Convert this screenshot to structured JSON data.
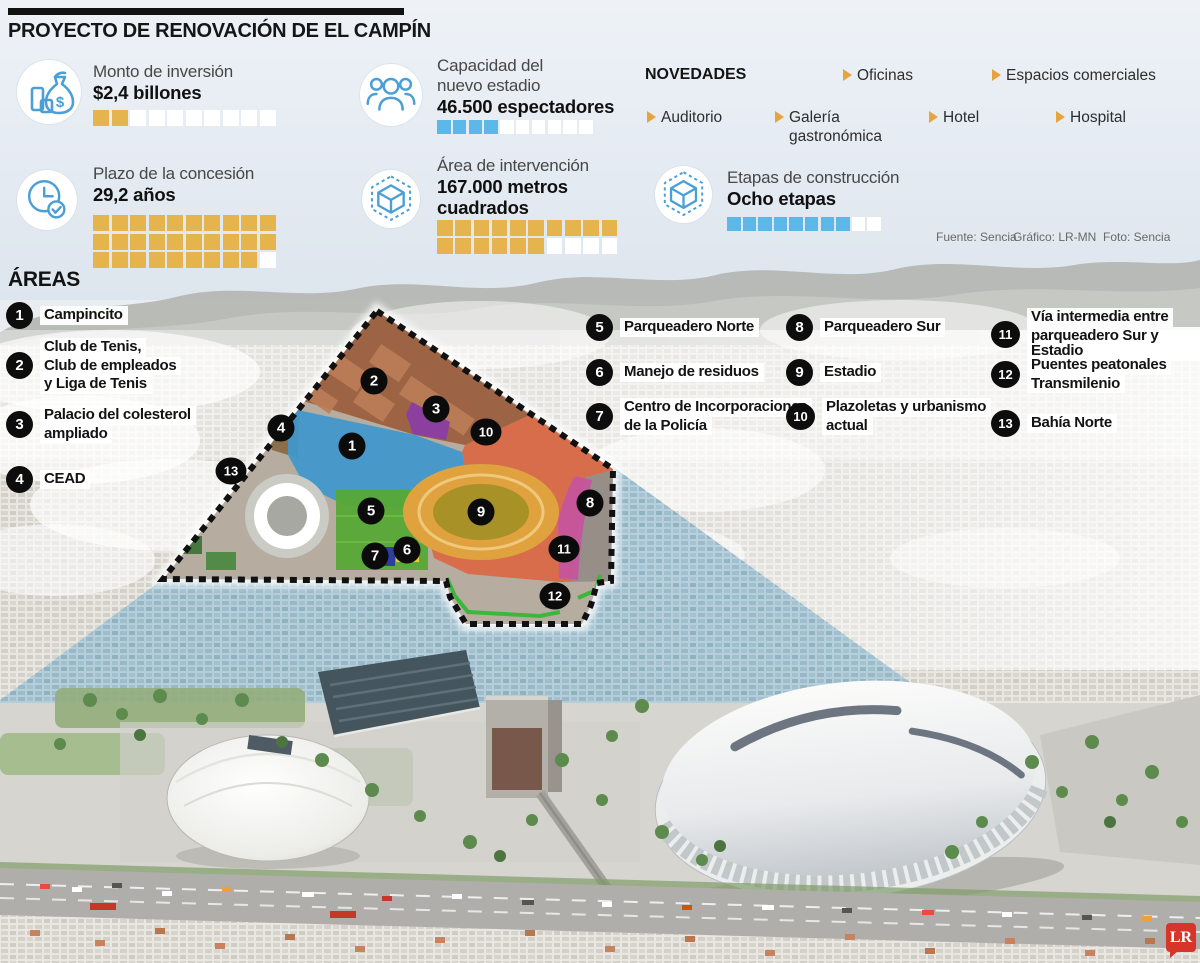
{
  "title": "PROYECTO DE RENOVACIÓN DE EL CAMPÍN",
  "colors": {
    "accent_gold": "#e6b44c",
    "accent_blue": "#5cb8e8",
    "square_empty": "#ffffff",
    "icon_blue": "#4aa0d6",
    "marker_black": "#0b0b0b",
    "logo_red": "#d8352a"
  },
  "stats": {
    "monto": {
      "icon": "money-bag-icon",
      "label_lines": [
        "Monto de inversión"
      ],
      "value_lines": [
        "$2,4 billones"
      ],
      "squares": {
        "filled": 2,
        "total": 10,
        "per_row": 10,
        "color": "#e6b44c"
      }
    },
    "capacidad": {
      "icon": "people-icon",
      "label_lines": [
        "Capacidad del",
        "nuevo estadio"
      ],
      "value_lines": [
        "46.500 espectadores"
      ],
      "squares": {
        "filled": 4,
        "total": 10,
        "per_row": 10,
        "color": "#5cb8e8"
      }
    },
    "plazo": {
      "icon": "clock-icon",
      "label_lines": [
        "Plazo de la concesión"
      ],
      "value_lines": [
        "29,2 años"
      ],
      "squares": {
        "filled": 29,
        "total": 30,
        "per_row": 10,
        "color": "#e6b44c"
      }
    },
    "area": {
      "icon": "cube-icon",
      "label_lines": [
        "Área de intervención"
      ],
      "value_lines": [
        "167.000 metros",
        "cuadrados"
      ],
      "squares": {
        "filled": 16,
        "total": 20,
        "per_row": 10,
        "color": "#e6b44c"
      }
    },
    "etapas": {
      "icon": "cube-icon",
      "label_lines": [
        "Etapas de construcción"
      ],
      "value_lines": [
        "Ocho etapas"
      ],
      "squares": {
        "filled": 8,
        "total": 10,
        "per_row": 10,
        "color": "#5cb8e8"
      }
    }
  },
  "novedades": {
    "heading": "NOVEDADES",
    "items": [
      "Auditorio",
      "Galería gastronómica",
      "Oficinas",
      "Espacios comerciales",
      "Hotel",
      "Hospital"
    ]
  },
  "credits": {
    "fuente": "Fuente: Sencia",
    "grafico": "Gráfico: LR-MN",
    "foto": "Foto: Sencia"
  },
  "areas": {
    "heading": "ÁREAS",
    "items": [
      {
        "num": "1",
        "lines": [
          "Campincito"
        ]
      },
      {
        "num": "2",
        "lines": [
          "Club de Tenis,",
          "Club de empleados",
          "y Liga de Tenis"
        ]
      },
      {
        "num": "3",
        "lines": [
          "Palacio del colesterol",
          "ampliado"
        ]
      },
      {
        "num": "4",
        "lines": [
          "CEAD"
        ]
      },
      {
        "num": "5",
        "lines": [
          "Parqueadero Norte"
        ]
      },
      {
        "num": "6",
        "lines": [
          "Manejo de residuos"
        ]
      },
      {
        "num": "7",
        "lines": [
          "Centro de Incorporaciones",
          "de la Policía"
        ]
      },
      {
        "num": "8",
        "lines": [
          "Parqueadero Sur"
        ]
      },
      {
        "num": "9",
        "lines": [
          "Estadio"
        ]
      },
      {
        "num": "10",
        "lines": [
          "Plazoletas y urbanismo",
          "actual"
        ]
      },
      {
        "num": "11",
        "lines": [
          "Vía intermedia entre",
          "parqueadero Sur y Estadio"
        ]
      },
      {
        "num": "12",
        "lines": [
          "Puentes peatonales",
          "Transmilenio"
        ]
      },
      {
        "num": "13",
        "lines": [
          "Bahía Norte"
        ]
      }
    ]
  },
  "map_markers": [
    {
      "n": "1",
      "x": 352,
      "y": 446
    },
    {
      "n": "2",
      "x": 374,
      "y": 381
    },
    {
      "n": "3",
      "x": 436,
      "y": 409
    },
    {
      "n": "4",
      "x": 281,
      "y": 428
    },
    {
      "n": "5",
      "x": 371,
      "y": 511
    },
    {
      "n": "6",
      "x": 407,
      "y": 550
    },
    {
      "n": "7",
      "x": 375,
      "y": 556
    },
    {
      "n": "8",
      "x": 590,
      "y": 503
    },
    {
      "n": "9",
      "x": 481,
      "y": 512
    },
    {
      "n": "10",
      "x": 486,
      "y": 432
    },
    {
      "n": "11",
      "x": 564,
      "y": 549
    },
    {
      "n": "12",
      "x": 555,
      "y": 596
    },
    {
      "n": "13",
      "x": 231,
      "y": 471
    }
  ],
  "logo": "LR"
}
